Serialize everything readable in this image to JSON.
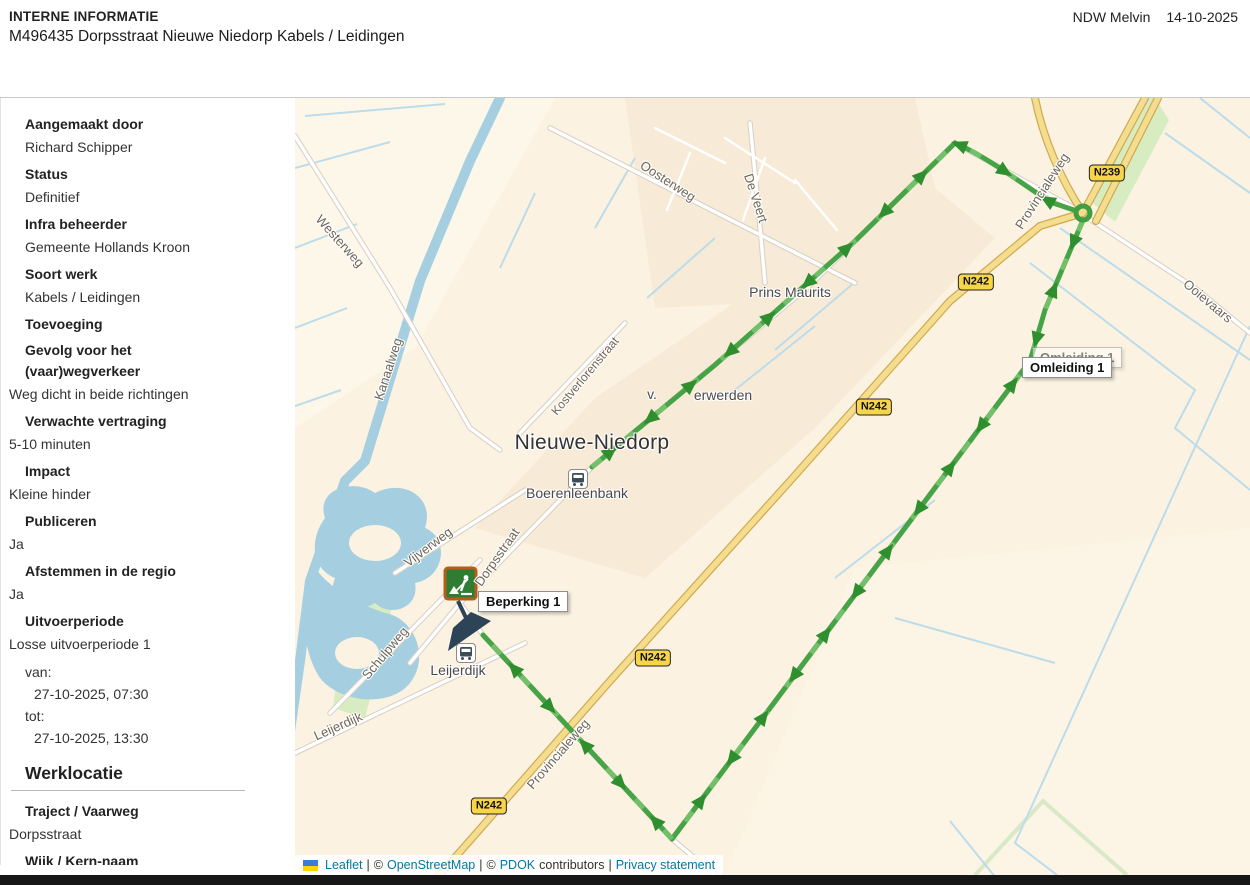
{
  "header": {
    "tag": "INTERNE INFORMATIE",
    "title": "M496435 Dorpsstraat Nieuwe Niedorp Kabels / Leidingen",
    "user": "NDW Melvin",
    "date": "14-10-2025"
  },
  "sidebar": {
    "fields": [
      {
        "label": "Aangemaakt door",
        "value": "Richard Schipper"
      },
      {
        "label": "Status",
        "value": "Definitief"
      },
      {
        "label": "Infra beheerder",
        "value": "Gemeente Hollands Kroon"
      },
      {
        "label": "Soort werk",
        "value": "Kabels / Leidingen"
      },
      {
        "label": "Toevoeging",
        "value": ""
      },
      {
        "label": "Gevolg voor het (vaar)wegverkeer",
        "value": "Weg dicht in beide richtingen"
      },
      {
        "label": "Verwachte vertraging",
        "value": "5-10 minuten"
      },
      {
        "label": "Impact",
        "value": "Kleine hinder"
      },
      {
        "label": "Publiceren",
        "value": "Ja"
      },
      {
        "label": "Afstemmen in de regio",
        "value": "Ja"
      },
      {
        "label": "Uitvoerperiode",
        "value": "Losse uitvoerperiode 1"
      }
    ],
    "period": {
      "from_label": "van:",
      "from": "27-10-2025, 07:30",
      "to_label": "tot:",
      "to": "27-10-2025, 13:30"
    },
    "section_title": "Werklocatie",
    "location_fields": [
      {
        "label": "Traject / Vaarweg",
        "value": "Dorpsstraat"
      },
      {
        "label": "Wijk / Kern-naam",
        "value": ""
      },
      {
        "label": "Plaatsnaam",
        "value": ""
      }
    ]
  },
  "map": {
    "town": "Nieuwe-Niedorp",
    "labels": {
      "westerweg": "Westerweg",
      "oosterweg": "Oosterweg",
      "de_veert": "De Veert",
      "kanaalweg": "Kanaalweg",
      "prins_maurits": "Prins Maurits",
      "kostverlorenstraat": "Kostverlorenstraat",
      "v_prefix": "v.",
      "erwerden": "erwerden",
      "boerenleenbank": "Boerenleenbank",
      "vijverweg": "Vijverweg",
      "dorpsstraat": "Dorpsstraat",
      "schulpweg": "Schulpweg",
      "leijerdijk": "Leijerdijk",
      "leijerdijk2": "Leijerdijk",
      "provincialeweg_top": "Provincialeweg",
      "provincialeweg_bottom": "Provincialeweg",
      "ooievaars": "Ooievaars"
    },
    "badges": {
      "n239": "N239",
      "n242": "N242"
    },
    "markers": {
      "beperking": "Beperking 1",
      "omleiding": "Omleiding 1"
    },
    "attribution": {
      "leaflet": "Leaflet",
      "sep1": "|",
      "c1": "©",
      "osm": "OpenStreetMap",
      "sep2": "|",
      "c2": "©",
      "pdok": "PDOK",
      "contributors": "contributors",
      "sep3": "|",
      "privacy": "Privacy statement"
    }
  }
}
